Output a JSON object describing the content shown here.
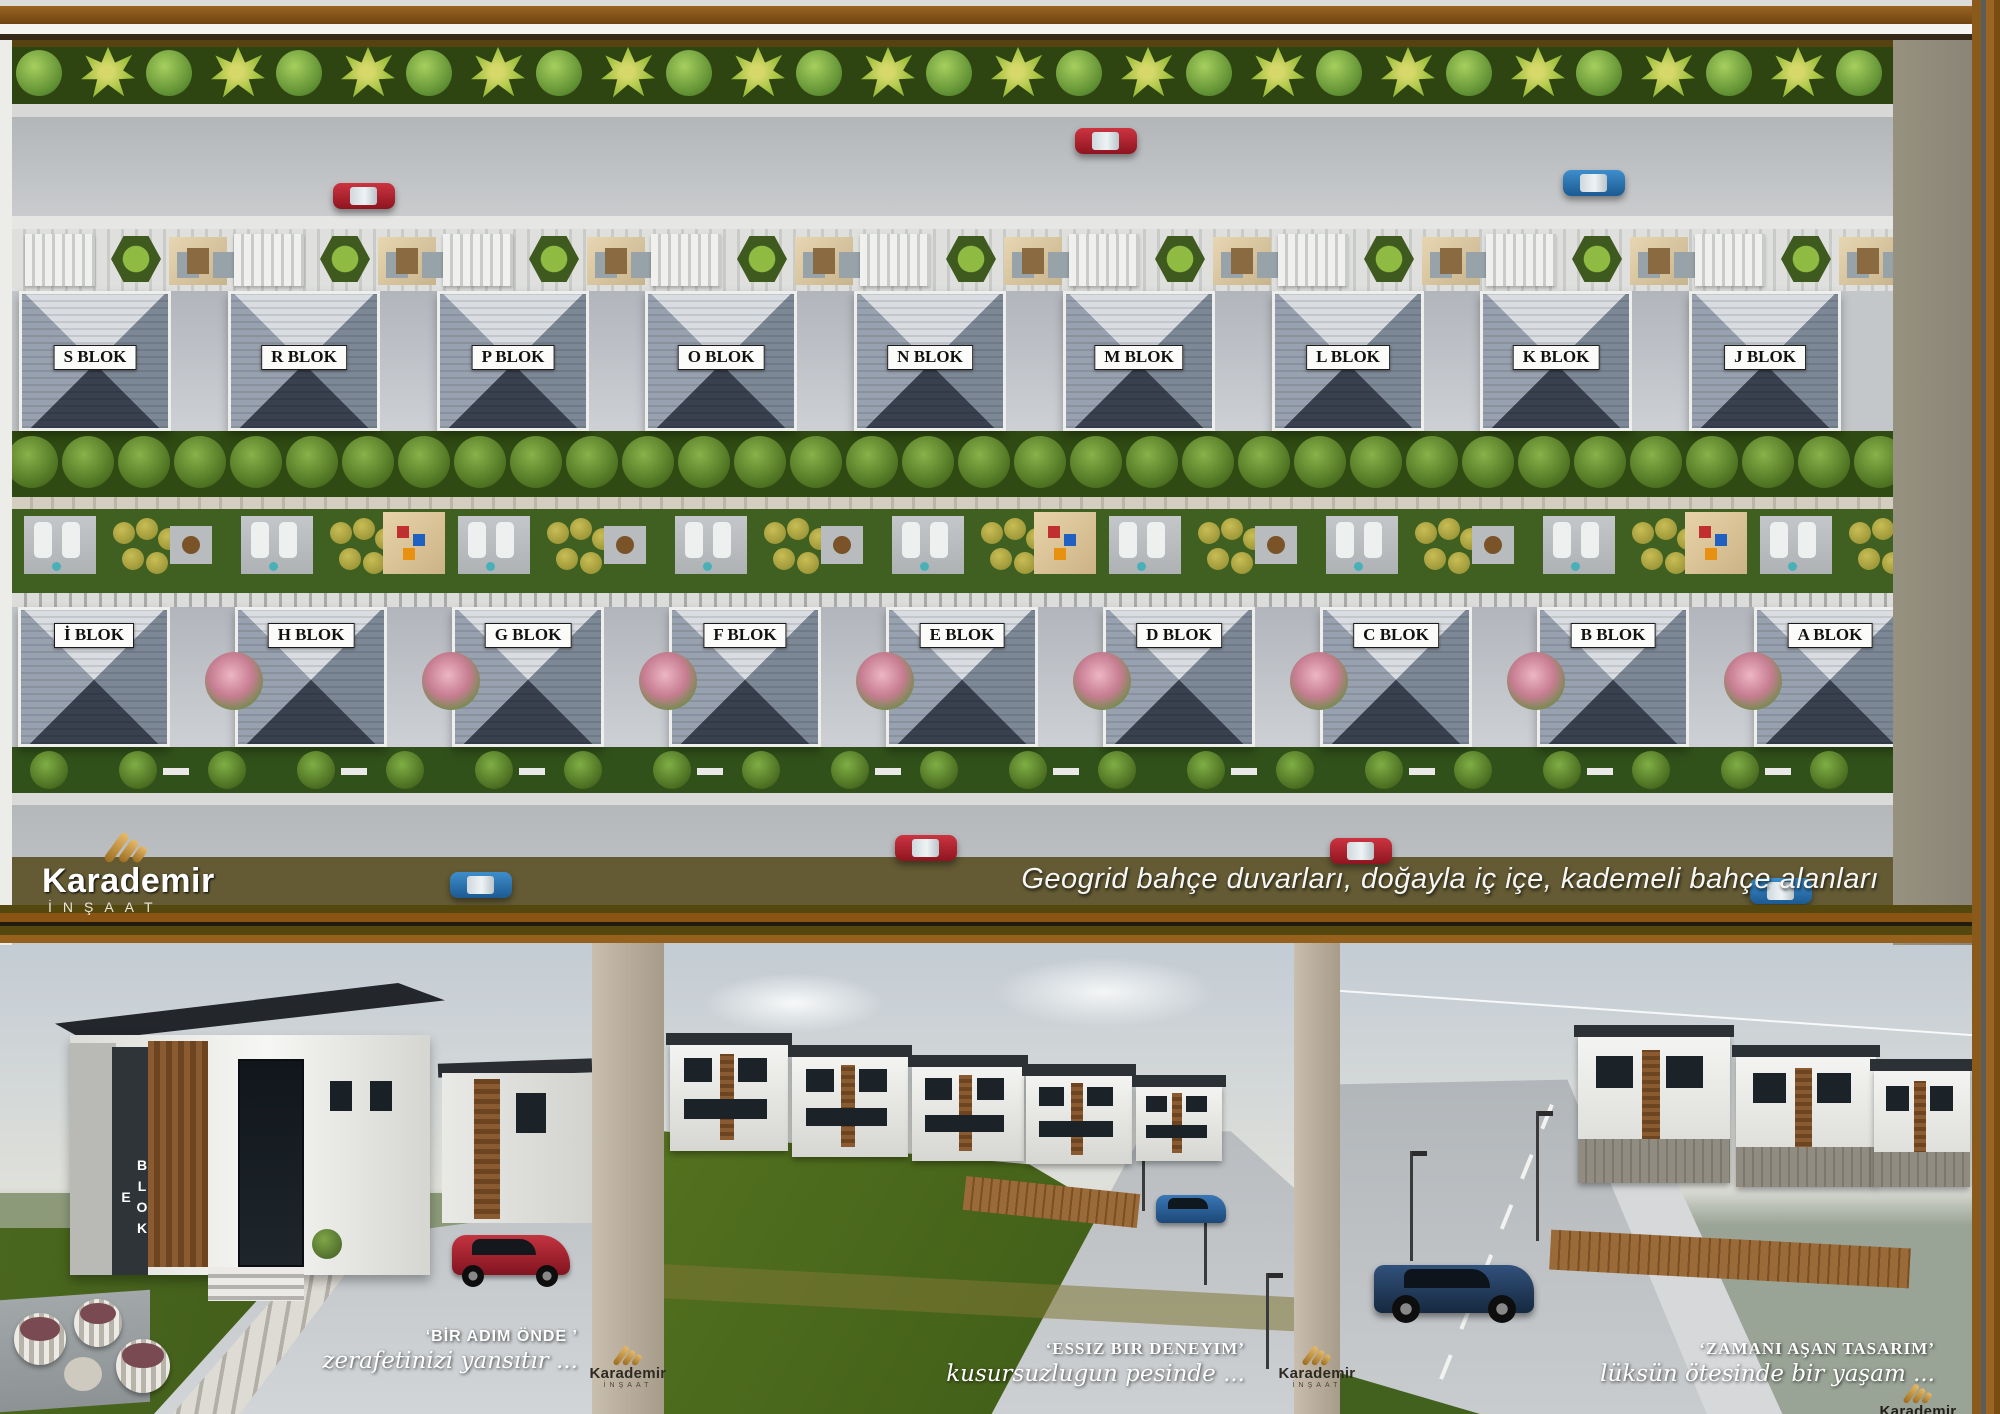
{
  "brand": {
    "name": "Karademir",
    "subtitle": "İNŞAAT"
  },
  "tagline": "Geogrid bahçe duvarları, doğayla iç içe, kademeli bahçe alanları",
  "site_plan": {
    "top_row_blocks": [
      "S BLOK",
      "R BLOK",
      "P BLOK",
      "O BLOK",
      "N BLOK",
      "M BLOK",
      "L BLOK",
      "K BLOK",
      "J BLOK"
    ],
    "bottom_row_blocks": [
      "İ BLOK",
      "H BLOK",
      "G BLOK",
      "F BLOK",
      "E BLOK",
      "D BLOK",
      "C BLOK",
      "B BLOK",
      "A BLOK"
    ]
  },
  "panels": [
    {
      "title": "‘BİR ADIM ÖNDE ’",
      "subtitle": "zerafetinizi yansıtır ...",
      "building_sign": "E BLOK"
    },
    {
      "title": "‘ESSIZ BIR DENEYIM’",
      "subtitle": "kusursuzlugun pesinde ..."
    },
    {
      "title": "‘ZAMANI AŞAN TASARIM’",
      "subtitle": "lüksün ötesinde bir yaşam ..."
    }
  ],
  "colors": {
    "frame_brown": "#8a5a1c",
    "gold": "#c89a4a",
    "band_olive": "#4a3e0c",
    "roof_slate": "#39414f",
    "accent_red": "#b02430",
    "accent_blue": "#2878b8"
  }
}
